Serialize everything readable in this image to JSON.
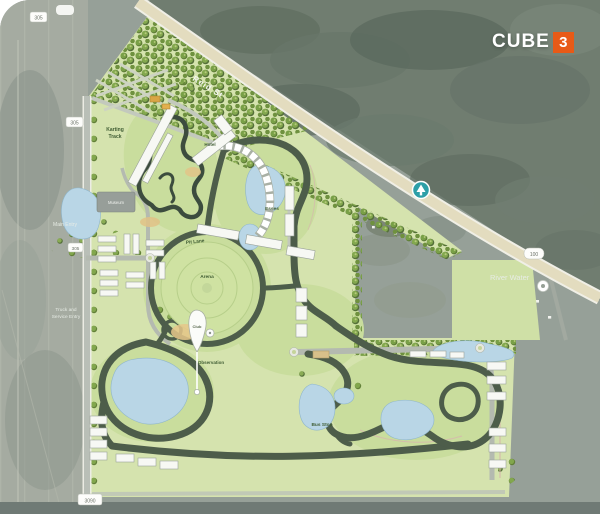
{
  "logo": {
    "brand": "CUBE",
    "badge": "3"
  },
  "roads": {
    "reid_st": "Reid St",
    "route_left_top": "305",
    "route_left_mid": "305",
    "route_left_lower": "305",
    "route_bottom": "3090",
    "route_highway": "100"
  },
  "plan_labels": {
    "karting_1": "Karting",
    "karting_2": "Track",
    "museum": "Museum",
    "hotel": "Hotel",
    "pit_lane": "Pit Lane",
    "arena": "Arena",
    "esses": "Esses",
    "club": "Club",
    "observation": "Observation",
    "bus_stop": "Bus Stop"
  },
  "satellite_labels": {
    "main_entry": "Main Entry",
    "truck_entry_1": "Truck and",
    "truck_entry_2": "Service Entry",
    "river_water": "River Water"
  },
  "colors": {
    "site_green": "#d5e3ae",
    "track": "#4d5d4a",
    "water": "#b9d6e6",
    "road_tan": "#e3dcbf",
    "logo_orange": "#e85a17",
    "marker_teal": "#2d9fa7"
  }
}
